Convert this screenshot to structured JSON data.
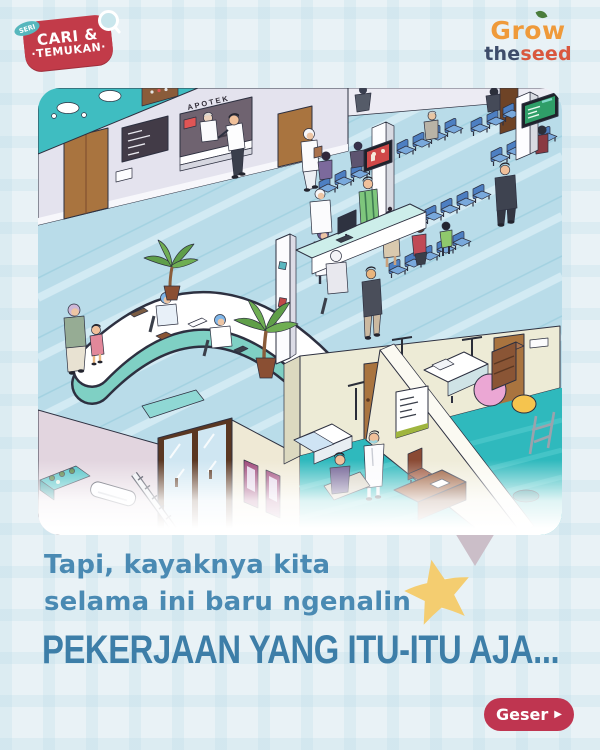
{
  "badge": {
    "seri": "SERI",
    "line1": "CARI &",
    "line2": "·TEMUKAN·"
  },
  "brand": {
    "grow_pre": "Gr",
    "grow_o": "o",
    "grow_post": "w",
    "the": "the",
    "seed": "seed"
  },
  "illustration": {
    "apotek_sign": "APOTEK"
  },
  "caption": {
    "line1": "Tapi, kayaknya kita",
    "line2": "selama ini baru ngenalin"
  },
  "headline": {
    "text": "PEKERJAAN YANG ITU-ITU AJA..."
  },
  "cta": {
    "label": "Geser",
    "arrow": "▶"
  },
  "palette": {
    "page_bg": "#e9f2f6",
    "card_bg": "#ffffff",
    "badge_red": "#c23b49",
    "badge_teal": "#57b7bd",
    "brand_orange": "#ef9a3a",
    "brand_navy": "#3d4c6a",
    "brand_red": "#d9573e",
    "caption_blue": "#4a8ab3",
    "headline_blue": "#3d7ea8",
    "star_yellow": "#f4cd70",
    "cta_red": "#bf3550",
    "floor_blue": "#b9dce9",
    "floor_teal": "#2fb9bd",
    "wall_lavender": "#e4e3ee",
    "wall_cream": "#edebd6",
    "wall_mauve": "#e2d5df",
    "door_brown": "#a9743f",
    "chair_blue": "#79a9dc",
    "desk_teal": "#7fd0c4"
  }
}
